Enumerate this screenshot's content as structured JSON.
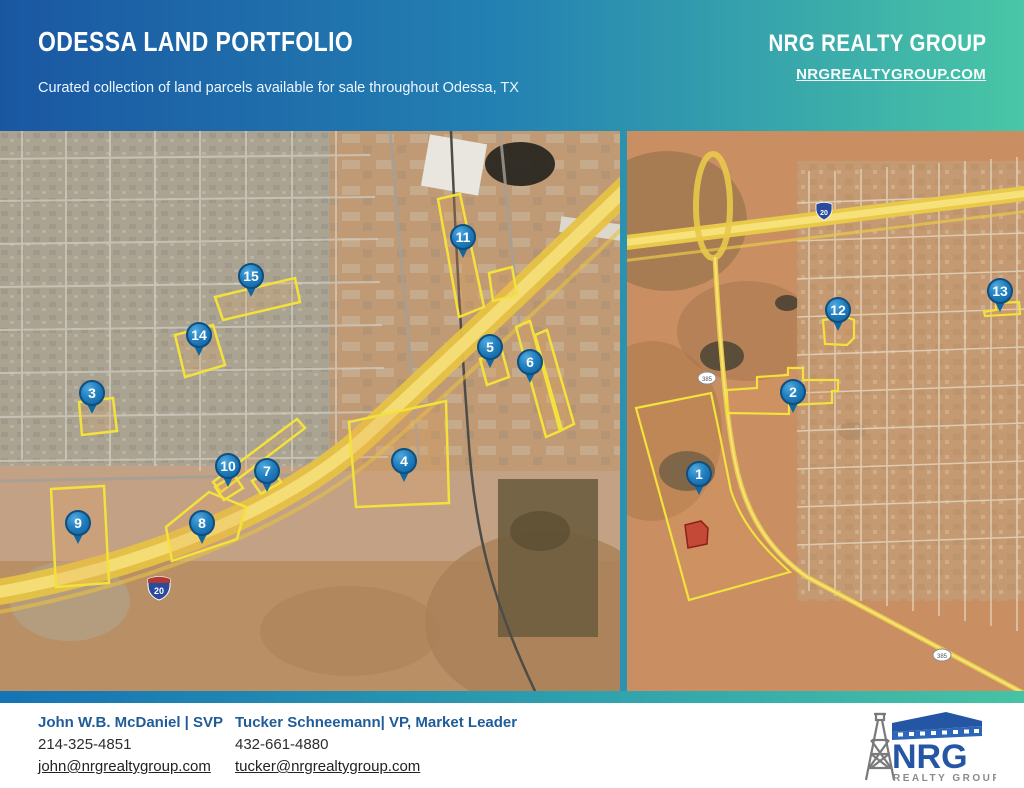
{
  "header": {
    "title": "ODESSA LAND PORTFOLIO",
    "subtitle": "Curated collection of land parcels available for sale throughout Odessa, TX",
    "company": "NRG REALTY GROUP",
    "website": "NRGREALTYGROUP.COM"
  },
  "maps": {
    "left": {
      "interstate_shield": "20",
      "markers": [
        {
          "n": "3",
          "x": 92,
          "y": 262
        },
        {
          "n": "4",
          "x": 404,
          "y": 330
        },
        {
          "n": "5",
          "x": 490,
          "y": 216
        },
        {
          "n": "6",
          "x": 530,
          "y": 231
        },
        {
          "n": "7",
          "x": 267,
          "y": 340
        },
        {
          "n": "8",
          "x": 202,
          "y": 392
        },
        {
          "n": "9",
          "x": 78,
          "y": 392
        },
        {
          "n": "10",
          "x": 228,
          "y": 335
        },
        {
          "n": "11",
          "x": 463,
          "y": 106
        },
        {
          "n": "14",
          "x": 199,
          "y": 204
        },
        {
          "n": "15",
          "x": 251,
          "y": 145
        }
      ]
    },
    "right": {
      "interstate_shield": "20",
      "highway_shield": "385",
      "markers": [
        {
          "n": "1",
          "x": 72,
          "y": 343
        },
        {
          "n": "2",
          "x": 166,
          "y": 261
        },
        {
          "n": "12",
          "x": 211,
          "y": 179
        },
        {
          "n": "13",
          "x": 373,
          "y": 160
        }
      ]
    }
  },
  "footer": {
    "contacts": [
      {
        "name": "John W.B. McDaniel | SVP",
        "phone": "214-325-4851",
        "email": "john@nrgrealtygroup.com"
      },
      {
        "name": "Tucker Schneemann| VP, Market Leader",
        "phone": "432-661-4880",
        "email": "tucker@nrgrealtygroup.com"
      }
    ],
    "logo": {
      "name": "NRG",
      "tagline": "REALTY GROUP"
    }
  }
}
